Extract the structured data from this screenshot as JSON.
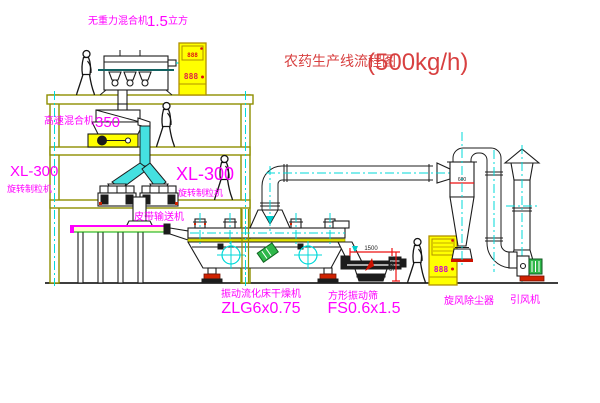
{
  "title": {
    "name": "农药生产线流程图",
    "capacity": "(500kg/h)"
  },
  "equipment": {
    "gravity_mixer": {
      "label": "无重力混合机",
      "size": "1.5",
      "unit": "立方"
    },
    "high_speed_mixer": {
      "label": "高速混合机",
      "size": "350"
    },
    "granulator_left": {
      "model": "XL-300",
      "label": "旋转制粒机"
    },
    "granulator_right": {
      "model": "XL-300",
      "label": "旋转制粒机"
    },
    "belt_conveyor": {
      "label": "皮带输送机"
    },
    "fluid_bed_dryer": {
      "label": "振动流化床干燥机",
      "model": "ZLG6x0.75"
    },
    "vibrating_screen": {
      "label": "方形振动筛",
      "model": "FS0.6x1.5"
    },
    "cyclone": {
      "label": "旋风除尘器"
    },
    "induced_draft_fan": {
      "label": "引风机"
    }
  },
  "dimensions": {
    "screen_length": "1500",
    "screen_height": "580",
    "cyclone_diameter": "600"
  },
  "control_panels": {
    "top_panel": {
      "upper_display": "888",
      "lower_display": "888"
    },
    "right_panel": {
      "display": "888"
    }
  },
  "colors": {
    "title_red": "#d84040",
    "label_magenta": "#ff00ff",
    "structure_olive": "#8f8f00",
    "centerline_cyan": "#00d9d9",
    "cabinet_yellow": "#ffff00",
    "duct_cyan": "#45e0e0",
    "bed_yellow": "#e3e300",
    "motor_green": "#2eb84a",
    "base_red": "#cf2200",
    "equipment_black": "#1c1c1c"
  }
}
